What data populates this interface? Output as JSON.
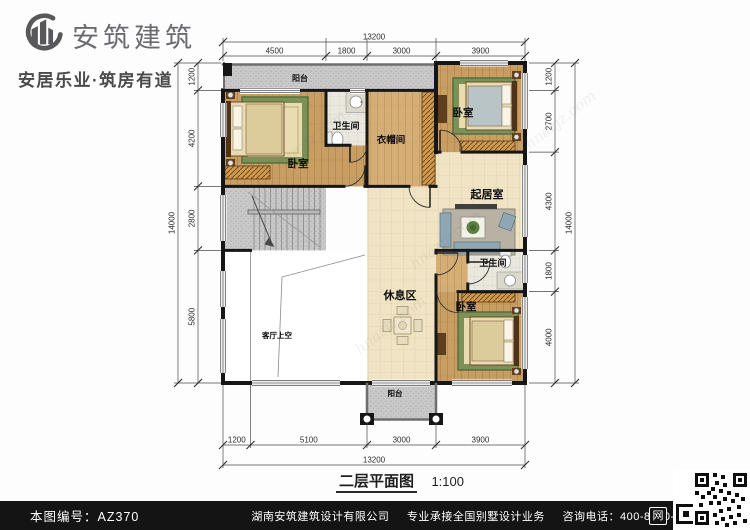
{
  "header": {
    "brand": "安筑建筑",
    "tagline": "安居乐业·筑房有道"
  },
  "plan": {
    "labels": {
      "balcony_top": "阳台",
      "bedroom_tl": "卧室",
      "bath_top": "卫生间",
      "cloakroom": "衣帽间",
      "bedroom_tr": "卧室",
      "living": "起居室",
      "rest": "休息区",
      "void_area": "客厅上空",
      "bath_bottom": "卫生间",
      "bedroom_br": "卧室",
      "balcony_bottom": "阳台"
    },
    "dims": {
      "top": {
        "total": "13200",
        "segments": [
          "4500",
          "1800",
          "3000",
          "3900"
        ]
      },
      "bottom": {
        "total": "13200",
        "segments": [
          "1200",
          "5100",
          "3000",
          "3900"
        ]
      },
      "left": {
        "total": "14000",
        "segments": [
          "1200",
          "4200",
          "2800",
          "5800"
        ]
      },
      "right": {
        "total": "14000",
        "segments": [
          "1200",
          "2700",
          "4300",
          "1800",
          "4000"
        ]
      }
    },
    "caption": {
      "title": "二层平面图",
      "scale": "1:100"
    }
  },
  "watermark": "hnazjz.com",
  "footer": {
    "drawing_no": "本图编号：AZ370",
    "company": "湖南安筑建筑设计有限公司",
    "services": "专业承接全国别墅设计业务",
    "phone": "咨询电话：400-8070-511",
    "net_badge": "网"
  },
  "colors": {
    "wall": "#161616",
    "wood": "#c89e63",
    "wood_light": "#d5ae76",
    "tile": "#f0e4c4",
    "gray_area": "#c8c8c8",
    "footer_bg": "#141414"
  }
}
